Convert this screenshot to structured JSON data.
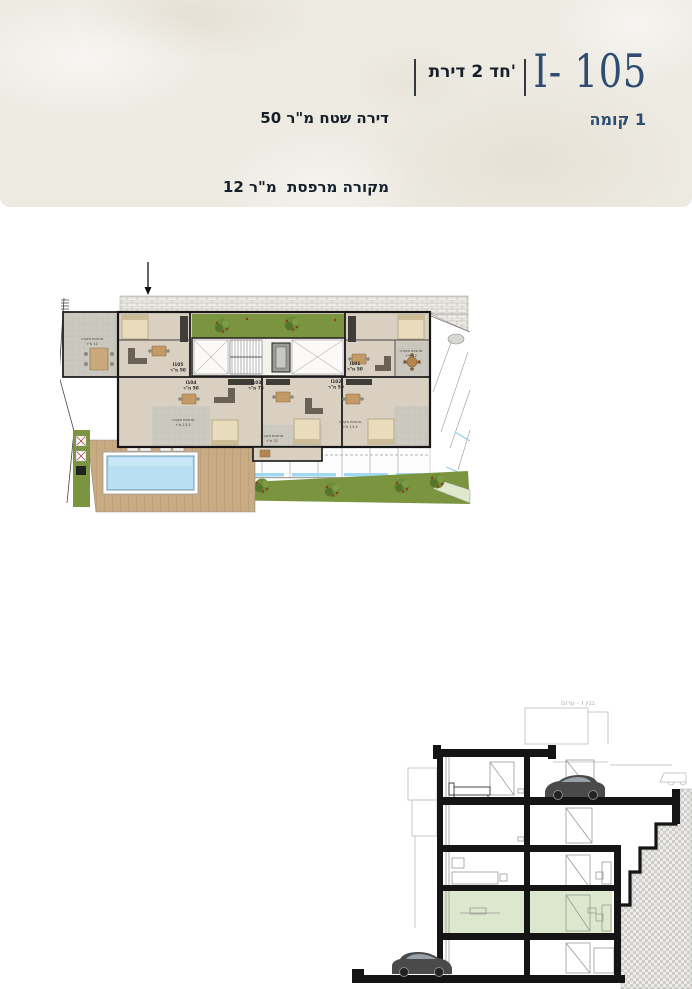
{
  "header": {
    "unit_code": "I- 105",
    "floor_label": "קומה‎ 1",
    "apartment_type": "דירת‎ 2 חד'",
    "spec_area": "50 מ\"ר‎ שטח‎ דירה",
    "spec_balcony": "12 מ\"ר‎  מרפסת‎ מקורה",
    "accent_color": "#2e4d71",
    "text_color": "#15202b"
  },
  "floor_plan": {
    "units": [
      {
        "id": "I105",
        "area": "50 מ\"ר"
      },
      {
        "id": "I104",
        "area": "50 מ\"ר"
      },
      {
        "id": "I103",
        "area": "75 מ\"ר"
      },
      {
        "id": "I102",
        "area": "50 מ\"ר"
      },
      {
        "id": "I101",
        "area": "50 מ\"ר"
      }
    ],
    "balconies": [
      {
        "label": "מרפסת מקורה",
        "area": "12 מ\"ר"
      },
      {
        "label": "מרפסת מקורה",
        "area": "13.5 מ\"ר"
      },
      {
        "label": "מרפסת מקורה",
        "area": "22 מ\"ר"
      },
      {
        "label": "מרפסת מקורה",
        "area": "13.5 מ\"ר"
      },
      {
        "label": "מרפסת מקורה",
        "area": "12 מ\"ר"
      }
    ],
    "garden_color": "#7b9440",
    "pool_color": "#b9e0f2",
    "wall_color": "#1a1a1a"
  },
  "section": {
    "caption": "בנין I - ערום",
    "highlight_color": "#dce8cd"
  }
}
